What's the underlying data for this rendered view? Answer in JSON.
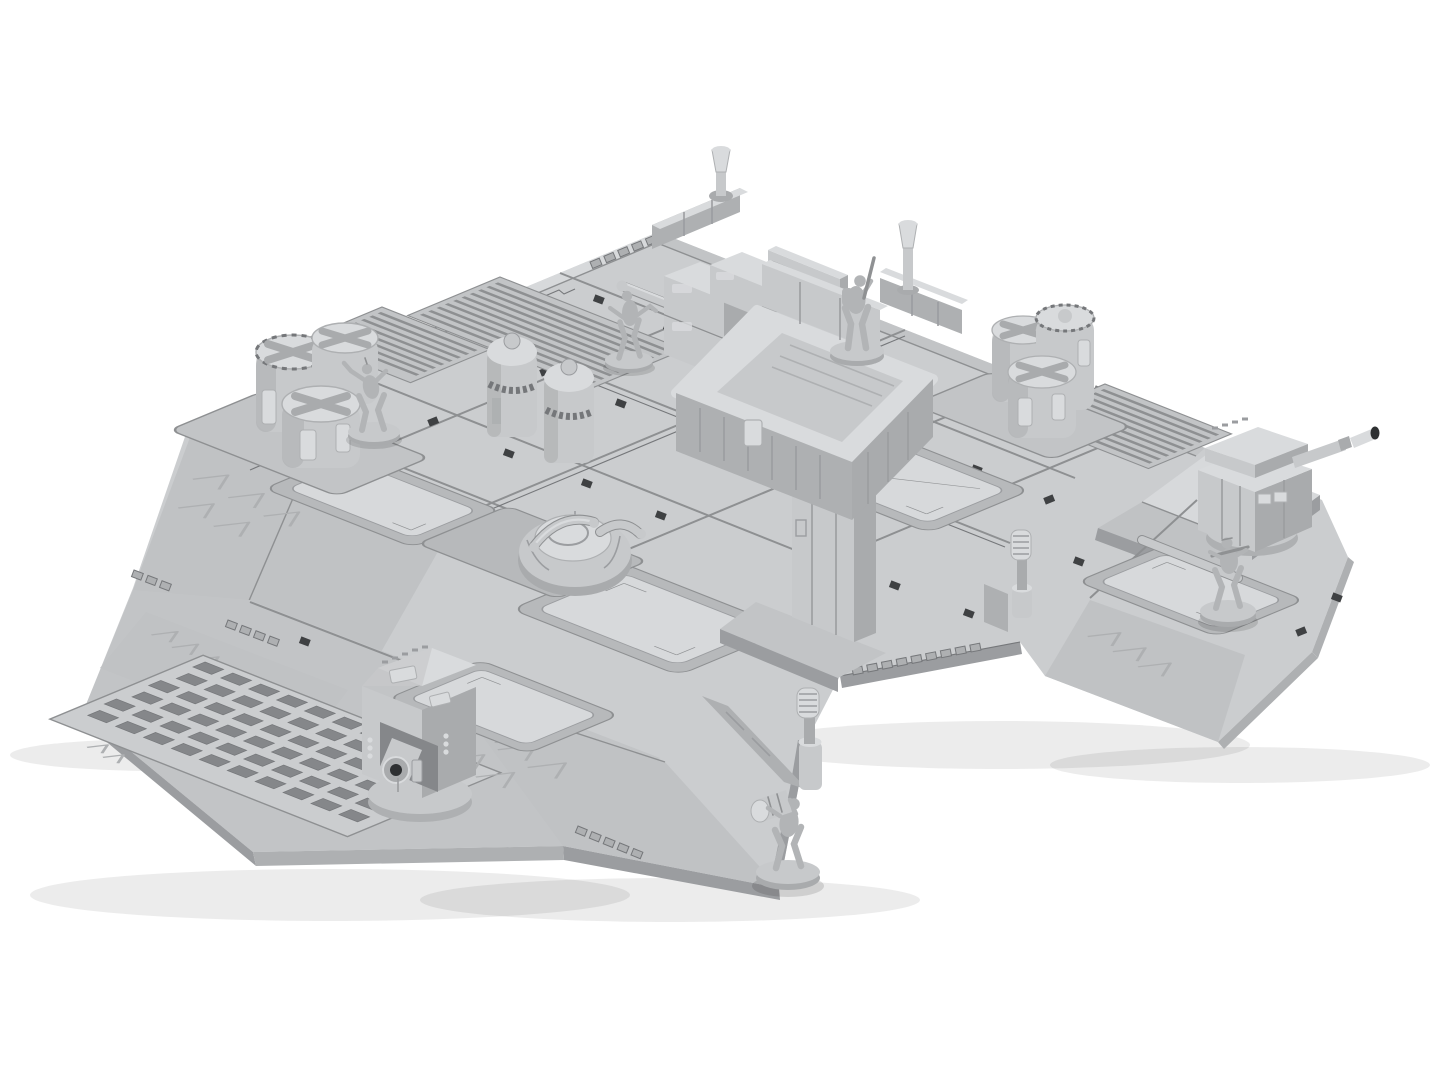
{
  "scene": {
    "type": "3d-render",
    "background_color": "#ffffff",
    "description": "Light grey 3D render of a modular sci-fi tabletop wargaming terrain board shown from an isometric angle on a plain white background: a tiled industrial deck with vent louvres, a floor grille, recessed hatches, a dome hatch with pipe rails, chevron access ramps, castellated edge trim, an elevated watchtower platform on a pillar, two gun turrets, fuel drum clusters, storage canisters, sensor masts and five soldier/robot miniatures on round bases",
    "board": {
      "label": "modular deck board",
      "features": [
        "tiled deck plates with panel seams",
        "louvered vent tiles",
        "slotted floor grille",
        "recessed hatch panels with corner chevrons",
        "dome hatch with pipe rails",
        "chevron warning ramps",
        "castellated edge trim",
        "clip sockets along seams",
        "surface conduit pipes"
      ]
    },
    "objects": [
      {
        "name": "watchtower-platform",
        "description": "elevated walled platform on a square pillar, soldier miniature aiming on top"
      },
      {
        "name": "supply-crates",
        "count": 3,
        "description": "stacked rectangular cargo crates beside the platform"
      },
      {
        "name": "louvered-wall-panel",
        "description": "slatted wall section behind the crates"
      },
      {
        "name": "storage-canisters",
        "count": 2,
        "description": "tall domed canister silos mid-deck"
      },
      {
        "name": "fuel-drum-cluster-left",
        "count": 3,
        "description": "three large drums on a base plate, west side"
      },
      {
        "name": "fuel-drum-cluster-right",
        "count": 3,
        "description": "three large drums on a base plate, east side"
      },
      {
        "name": "gun-turret-left",
        "description": "boxy automated turret, barrel toward viewer, south-west wing"
      },
      {
        "name": "gun-turret-right",
        "description": "boxy automated turret on raised corner tile, barrel up-right"
      },
      {
        "name": "dome-hatch",
        "description": "round dome hatch with pipe handles in a recessed tile"
      },
      {
        "name": "sensor-masts",
        "count": 4,
        "description": "pole-mounted sensor/light masts on low barrier walls"
      },
      {
        "name": "miniatures",
        "count": 5,
        "poses": [
          "robot trooper beside left fuel drums",
          "robot trooper walking mid-deck",
          "soldier aiming rifle on watchtower platform",
          "soldier advancing on right wing hatch",
          "soldier carrying a drum off-board at bottom edge"
        ]
      }
    ],
    "palette": {
      "background": "#ffffff",
      "deck": "#cbcdcf",
      "deck_light": "#d7d9db",
      "deck_mid": "#c2c4c6",
      "ramp": "#c0c2c4",
      "side": "#aeb0b2",
      "side_dark": "#9b9da0",
      "seam": "#8e9092",
      "groove": "#75777a",
      "recess": "#b7b9bb",
      "slot": "#85878a",
      "socket": "#3f4143",
      "object_light": "#d9dbdd",
      "object_mid": "#c7c9cb",
      "object_dark": "#a9abad",
      "metal_dark": "#2e3032",
      "figure": "#b2b4b6",
      "figure_line": "#8f9193"
    }
  }
}
